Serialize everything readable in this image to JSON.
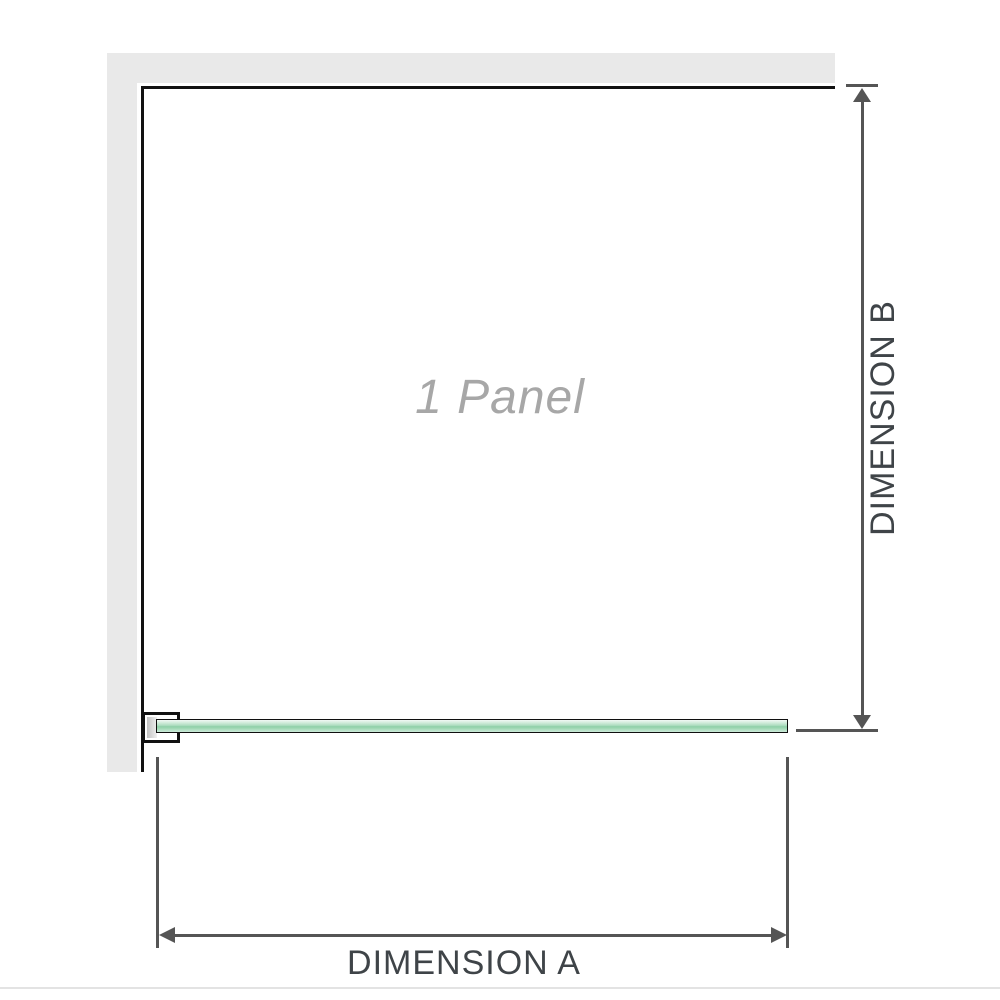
{
  "diagram": {
    "panel_label": "1 Panel",
    "dimension_a_label": "DIMENSION A",
    "dimension_b_label": "DIMENSION B"
  },
  "colors": {
    "wall": "#e9e9e9",
    "wall-edge": "#111111",
    "dim-line": "#555555",
    "dim-text": "#3f4448",
    "panel-text": "#a7a7a7",
    "glass-border": "#101010",
    "glass-light": "#d3ecdc",
    "glass-mid": "#aedec0",
    "glass-dark": "#8fcfa8",
    "bracket-metal": "#c2c2c2",
    "page-rule": "#e3e3e3"
  }
}
